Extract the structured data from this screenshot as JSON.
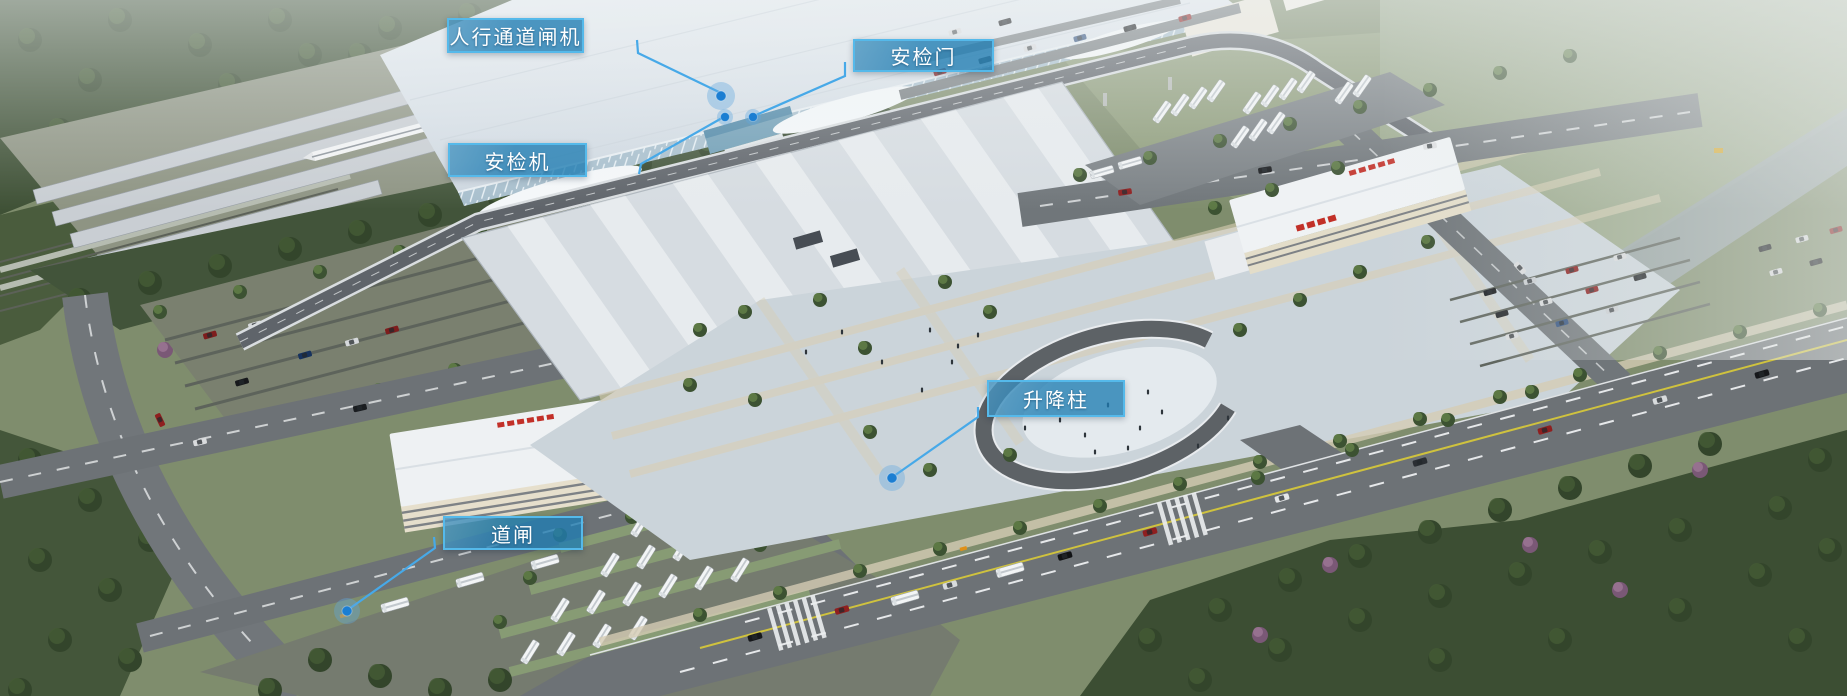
{
  "colors": {
    "callout_fill": "rgba(31,124,178,0.78)",
    "callout_border": "#55b9ea",
    "callout_text": "#ffffff",
    "leader_line": "#47a9e8",
    "dot_core": "#1b7ed2",
    "dot_halo": "rgba(96,168,224,0.38)"
  },
  "callouts": [
    {
      "id": "pedestrian-channel-gate",
      "label": "人行通道闸机",
      "box": {
        "x": 447,
        "y": 18,
        "w": 137,
        "h": 35
      },
      "line": [
        [
          637,
          40
        ],
        [
          638,
          53
        ],
        [
          721,
          93
        ]
      ],
      "dot": {
        "x": 721,
        "y": 96,
        "r": 5,
        "halo": 14
      }
    },
    {
      "id": "security-door",
      "label": "安检门",
      "box": {
        "x": 853,
        "y": 39,
        "w": 141,
        "h": 33
      },
      "line": [
        [
          845,
          62
        ],
        [
          845,
          76
        ],
        [
          756,
          115
        ]
      ],
      "dot": {
        "x": 753,
        "y": 117,
        "r": 4.5,
        "halo": 8
      }
    },
    {
      "id": "security-machine",
      "label": "安检机",
      "box": {
        "x": 448,
        "y": 143,
        "w": 139,
        "h": 34
      },
      "line": [
        [
          639,
          174
        ],
        [
          641,
          164
        ],
        [
          722,
          118
        ]
      ],
      "dot": {
        "x": 725,
        "y": 117,
        "r": 4.5,
        "halo": 8
      }
    },
    {
      "id": "lifting-bollard",
      "label": "升降柱",
      "box": {
        "x": 987,
        "y": 380,
        "w": 138,
        "h": 37
      },
      "line": [
        [
          978,
          407
        ],
        [
          978,
          417
        ],
        [
          894,
          476
        ]
      ],
      "dot": {
        "x": 892,
        "y": 478,
        "r": 5,
        "halo": 13
      }
    },
    {
      "id": "barrier-gate",
      "label": "道闸",
      "box": {
        "x": 443,
        "y": 516,
        "w": 140,
        "h": 34
      },
      "line": [
        [
          434,
          537
        ],
        [
          435,
          548
        ],
        [
          349,
          609
        ]
      ],
      "dot": {
        "x": 347,
        "y": 611,
        "r": 5,
        "halo": 13
      }
    }
  ]
}
